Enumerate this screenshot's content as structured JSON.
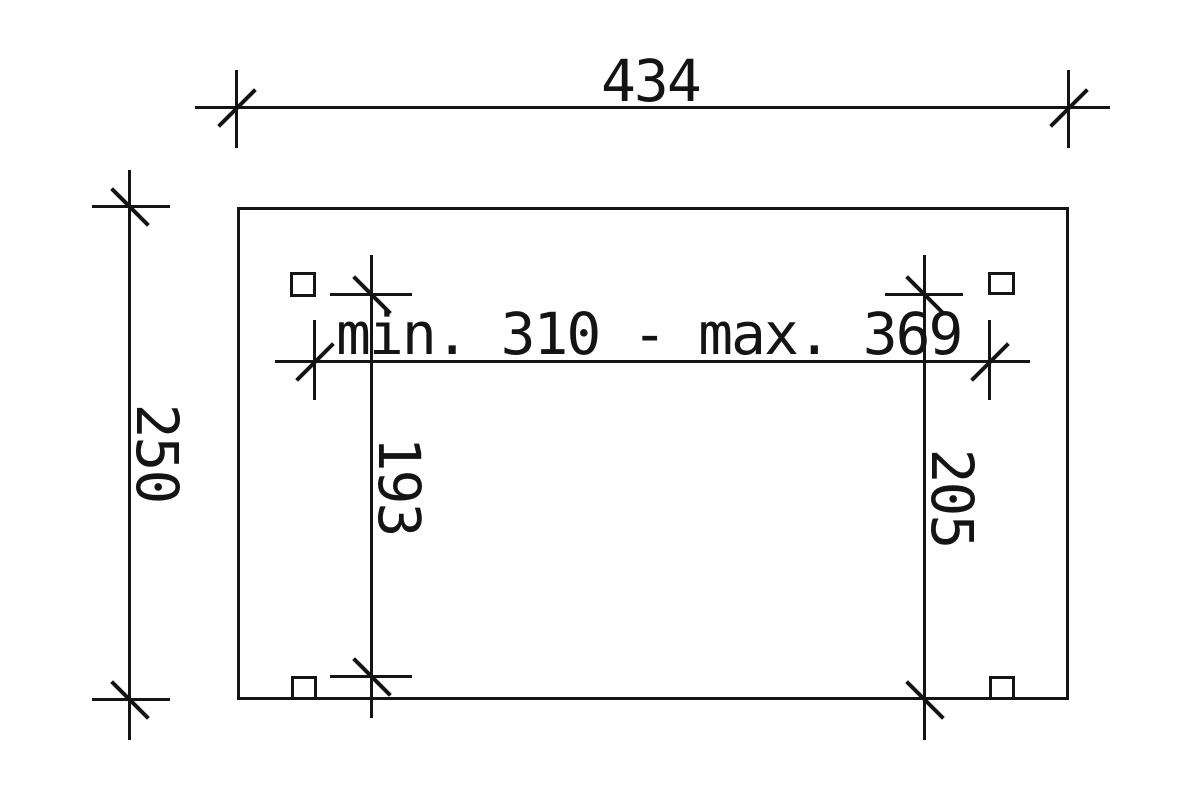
{
  "drawing": {
    "type": "technical-plan",
    "colors": {
      "line": "#141414",
      "background": "#ffffff"
    },
    "dimensions": {
      "top_width": {
        "label": "434",
        "orientation": "horizontal"
      },
      "left_height": {
        "label": "250",
        "orientation": "vertical"
      },
      "inner_span": {
        "label": "min. 310 - max. 369",
        "orientation": "horizontal"
      },
      "inner_left_height": {
        "label": "193",
        "orientation": "vertical"
      },
      "inner_right_height": {
        "label": "205",
        "orientation": "vertical"
      }
    },
    "posts": {
      "count": 4
    }
  }
}
